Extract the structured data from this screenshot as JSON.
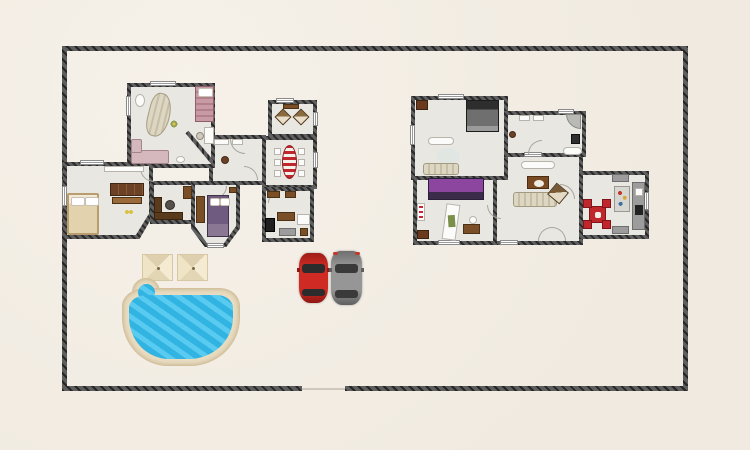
{
  "app": {
    "title": "home-floor-plan-canvas",
    "description": "Top-down 2D floor plan of a walled property with two houses, swimming pool, two parasols and two parked cars"
  },
  "palette": {
    "ground": "#f0eae0",
    "wall": "#4a4a4a",
    "wall-dark": "#262626",
    "floor": "#e9e7e2",
    "pool-water": "#35c0ee",
    "pool-deck": "#e9dcc0",
    "car-red": "#cf2b24",
    "car-gray": "#969696",
    "parasol": "#f0e6c9",
    "bed-purple": "#8d46a0",
    "bed-violet": "#6f5a80",
    "dining-red": "#c0272d",
    "wood": "#7a4f28",
    "wood-dark": "#5a3a1c"
  },
  "site": {
    "boundary": {
      "name": "property-boundary",
      "shape": "rectangle",
      "gate_gap_in_bottom_wall": true
    },
    "pool": {
      "name": "swimming-pool",
      "shape": "freeform-rounded",
      "features": [
        "beige-deck-border",
        "blue-water",
        "top-left-lobe"
      ]
    },
    "parasols": [
      {
        "name": "parasol"
      },
      {
        "name": "parasol"
      }
    ],
    "vehicles": [
      {
        "name": "red-car",
        "orientation": "vertical"
      },
      {
        "name": "gray-car",
        "orientation": "vertical"
      }
    ]
  },
  "left_house": {
    "name": "left-house",
    "rooms": [
      {
        "name": "salon",
        "furniture": [
          "curved-striped-sofa",
          "single-bed-pink",
          "corner-sofa-pink",
          "desk-with-chair",
          "floor-lamp",
          "plant"
        ]
      },
      {
        "name": "sitting-room",
        "furniture": [
          "armchair",
          "armchair",
          "console-table"
        ]
      },
      {
        "name": "dining-room",
        "furniture": [
          "oval-striped-table",
          "six-chairs"
        ]
      },
      {
        "name": "kitchen",
        "furniture": [
          "oven",
          "wood-cabinet",
          "sink-unit",
          "bar-tables",
          "stool"
        ]
      },
      {
        "name": "hall",
        "furniture": [
          "round-side-table",
          "bench",
          "bench"
        ]
      },
      {
        "name": "living-bedroom",
        "furniture": [
          "double-bed-beige",
          "drawer-dresser",
          "wall-shelf",
          "flowers"
        ]
      },
      {
        "name": "office",
        "furniture": [
          "l-shaped-desk",
          "office-chair",
          "cabinet"
        ]
      },
      {
        "name": "bay-bedroom",
        "furniture": [
          "double-bed-violet",
          "wardrobe",
          "nightstand"
        ]
      }
    ]
  },
  "right_house": {
    "name": "right-house",
    "rooms": [
      {
        "name": "bedroom",
        "furniture": [
          "double-bed-gray",
          "bench-white",
          "round-rug",
          "sofa-beige",
          "stove-corner"
        ]
      },
      {
        "name": "bathroom",
        "furniture": [
          "sink",
          "sink",
          "corner-shower",
          "toilet",
          "bathtub",
          "side-table"
        ]
      },
      {
        "name": "living-room",
        "furniture": [
          "bench-white",
          "coffee-table",
          "sofa-beige",
          "angled-armchair",
          "double-door"
        ]
      },
      {
        "name": "purple-bedroom",
        "furniture": [
          "double-bed-purple",
          "long-table",
          "shelf-unit",
          "desk-with-chair",
          "stove-corner"
        ]
      },
      {
        "name": "kitchen-dining",
        "furniture": [
          "red-table",
          "four-red-chairs",
          "counter-with-sink-and-stove",
          "island",
          "floor-mats"
        ]
      }
    ]
  }
}
